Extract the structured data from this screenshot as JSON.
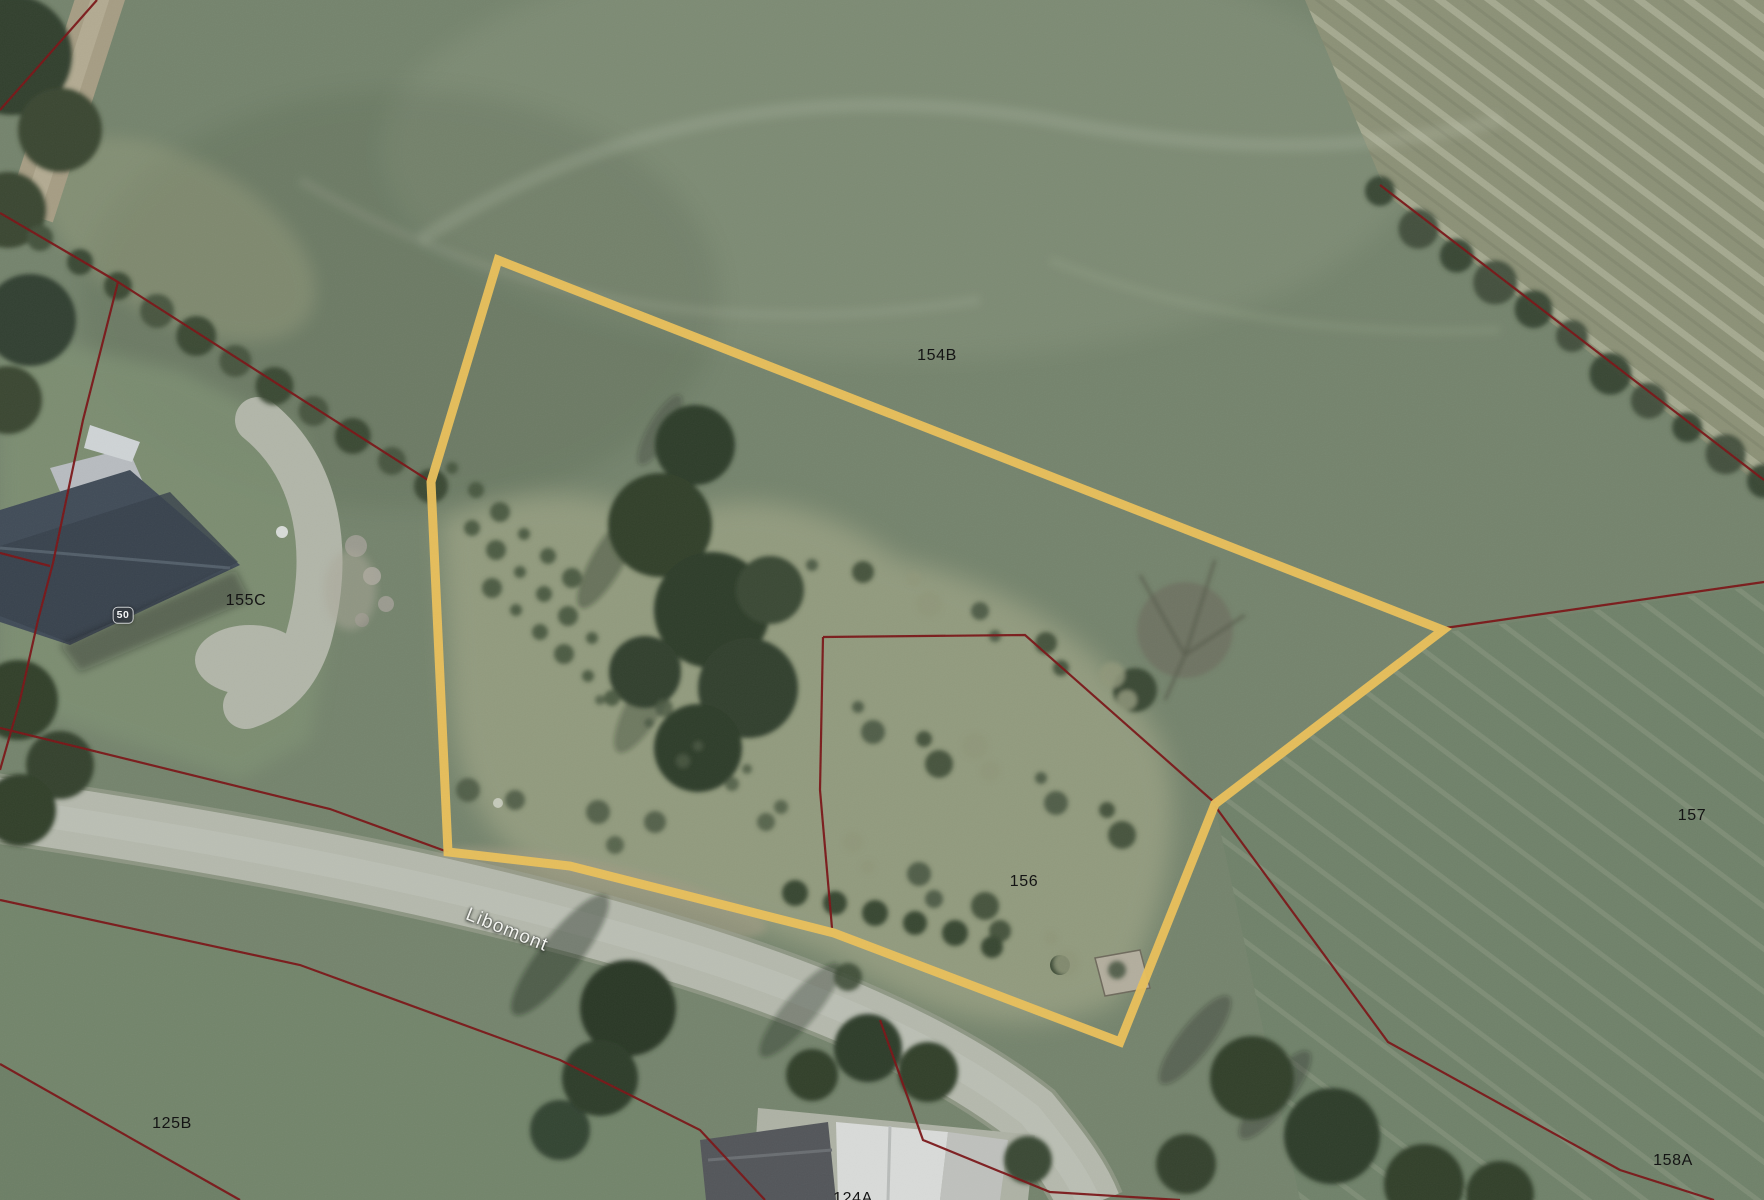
{
  "map": {
    "type": "aerial-cadastral-map",
    "labels": {
      "p154b": "154B",
      "p155c": "155C",
      "p157": "157",
      "p156": "156",
      "p125b": "125B",
      "p158a": "158A",
      "p124a": "124A",
      "house_number": "50",
      "street": "Libomont"
    },
    "colors": {
      "highlight": "#E8BF5A",
      "boundary": "#7A1517"
    },
    "highlighted_parcel": {
      "points": [
        [
          498,
          260
        ],
        [
          1443,
          630
        ],
        [
          1215,
          804
        ],
        [
          1120,
          1042
        ],
        [
          834,
          933
        ],
        [
          570,
          866
        ],
        [
          448,
          852
        ],
        [
          431,
          482
        ]
      ]
    },
    "boundary_lines": [
      {
        "name": "top-left-corner",
        "points": [
          [
            97,
            0
          ],
          [
            0,
            110
          ]
        ]
      },
      {
        "name": "hedge-northwest",
        "points": [
          [
            0,
            213
          ],
          [
            118,
            282
          ],
          [
            431,
            482
          ]
        ]
      },
      {
        "name": "through-house",
        "points": [
          [
            118,
            282
          ],
          [
            83,
            420
          ],
          [
            53,
            563
          ],
          [
            38,
            620
          ],
          [
            20,
            700
          ],
          [
            0,
            770
          ]
        ]
      },
      {
        "name": "west-spur",
        "points": [
          [
            0,
            553
          ],
          [
            50,
            566
          ]
        ]
      },
      {
        "name": "road-north",
        "points": [
          [
            0,
            728
          ],
          [
            330,
            809
          ],
          [
            448,
            852
          ]
        ]
      },
      {
        "name": "parcel156-top",
        "points": [
          [
            823,
            637
          ],
          [
            1025,
            635
          ],
          [
            1215,
            803
          ]
        ]
      },
      {
        "name": "parcel156-west",
        "points": [
          [
            823,
            637
          ],
          [
            820,
            790
          ],
          [
            832,
            928
          ]
        ]
      },
      {
        "name": "road-southwest",
        "points": [
          [
            0,
            900
          ],
          [
            300,
            965
          ],
          [
            560,
            1060
          ],
          [
            700,
            1130
          ],
          [
            765,
            1200
          ]
        ]
      },
      {
        "name": "bottom-left-corner",
        "points": [
          [
            0,
            1064
          ],
          [
            240,
            1200
          ]
        ]
      },
      {
        "name": "hedge-northeast",
        "points": [
          [
            1380,
            185
          ],
          [
            1764,
            480
          ]
        ]
      },
      {
        "name": "east-field",
        "points": [
          [
            1445,
            628
          ],
          [
            1764,
            582
          ]
        ]
      },
      {
        "name": "southeast",
        "points": [
          [
            1215,
            806
          ],
          [
            1388,
            1042
          ],
          [
            1620,
            1170
          ],
          [
            1714,
            1200
          ]
        ]
      },
      {
        "name": "south-crossing",
        "points": [
          [
            880,
            1020
          ],
          [
            923,
            1140
          ],
          [
            1050,
            1192
          ],
          [
            1180,
            1200
          ]
        ]
      }
    ]
  }
}
